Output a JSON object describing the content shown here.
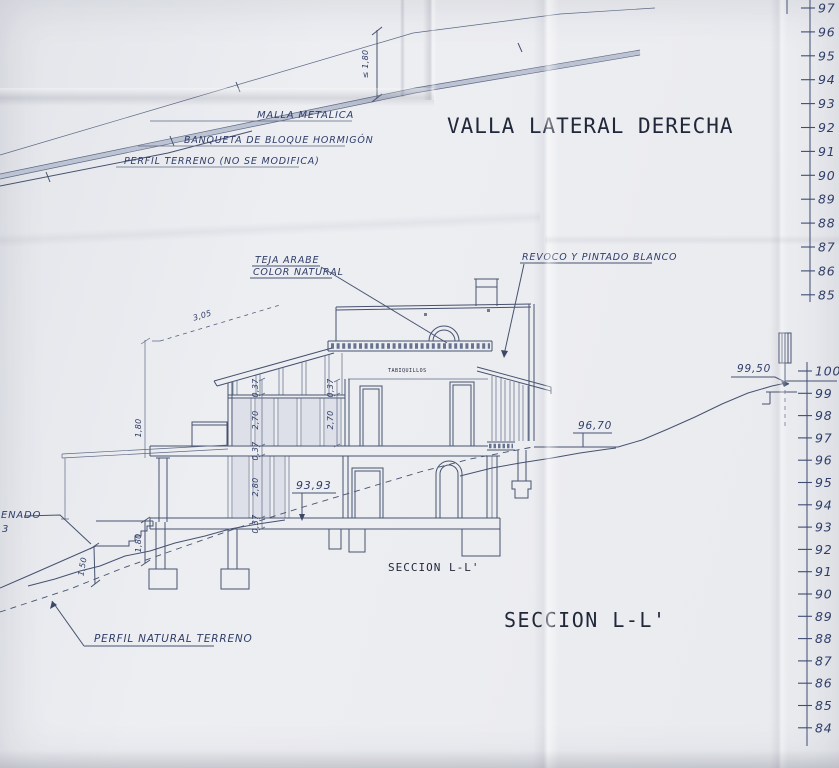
{
  "sheet": {
    "fence_title": "VALLA LATERAL DERECHA",
    "section_title": "SECCION L-L'",
    "section_caption": "SECCION L-L'"
  },
  "fence": {
    "malla_label": "MALLA METALICA",
    "banqueta_label": "BANQUETA DE BLOQUE HORMIGÓN",
    "perfil_label": "PERFIL TERRENO (NO SE MODIFICA)",
    "height_dim": "≤ 1,80"
  },
  "house": {
    "roof_label_line1": "TEJA ARABE",
    "roof_label_line2": "COLOR NATURAL",
    "wall_label": "REVOCO Y PINTADO BLANCO",
    "tabiquillos_label": "TABIQUILLOS",
    "terrain_label": "PERFIL NATURAL TERRENO",
    "edge_note_line1": "ENADO",
    "edge_note_line2": "3"
  },
  "elevations": {
    "interior_floor": "93,93",
    "ground_right": "96,70",
    "terrain_top_right": "99,50"
  },
  "dimensions": {
    "steps_to_terrain": "1,50",
    "steps_height": "1,80",
    "left_height": "1,80",
    "roof_slope": "3,05",
    "chain": [
      "0,37",
      "2,70",
      "0,37",
      "2,80",
      "0,37"
    ]
  },
  "scales": {
    "top": [
      "97",
      "96",
      "95",
      "94",
      "93",
      "92",
      "91",
      "90",
      "89",
      "88",
      "87",
      "86",
      "85"
    ],
    "bottom": [
      "100",
      "99",
      "98",
      "97",
      "96",
      "95",
      "94",
      "93",
      "92",
      "91",
      "90",
      "89",
      "88",
      "87",
      "86",
      "85",
      "84"
    ]
  },
  "colors": {
    "ink": "#46526f",
    "handwriting": "#2f3d69",
    "print": "#20283a",
    "paper": "#ecedf1"
  }
}
